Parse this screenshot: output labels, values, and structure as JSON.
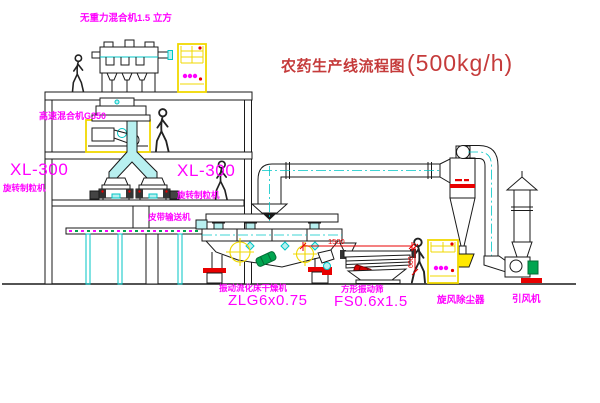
{
  "diagram": {
    "title": "农药生产线流程图",
    "title_capacity": "(500kg/h)"
  },
  "labels": {
    "gravity_mixer": "无重力混合机1.5 立方",
    "high_speed_mixer": "高速混合机G350",
    "granulator_left_model": "XL-300",
    "granulator_left_name": "旋转制粒机",
    "granulator_right_model": "XL-300",
    "granulator_right_name": "旋转制粒机",
    "belt_conveyor": "皮带输送机",
    "dryer_name": "振动流化床干燥机",
    "dryer_model": "ZLG6x0.75",
    "sieve_name": "方形振动筛",
    "sieve_model": "FS0.6x1.5",
    "cyclone": "旋风除尘器",
    "fan": "引风机"
  },
  "dimensions": {
    "sieve_length": "1500",
    "sieve_height": "600"
  },
  "colors": {
    "line": "#1a1a1a",
    "cyan": "#00c6c6",
    "cyan_fill": "#b8f0f0",
    "magenta": "#ff00ff",
    "red": "#e80000",
    "title_red": "#c53b3b",
    "yellow": "#f0d800",
    "green": "#00a550",
    "background": "#ffffff"
  }
}
